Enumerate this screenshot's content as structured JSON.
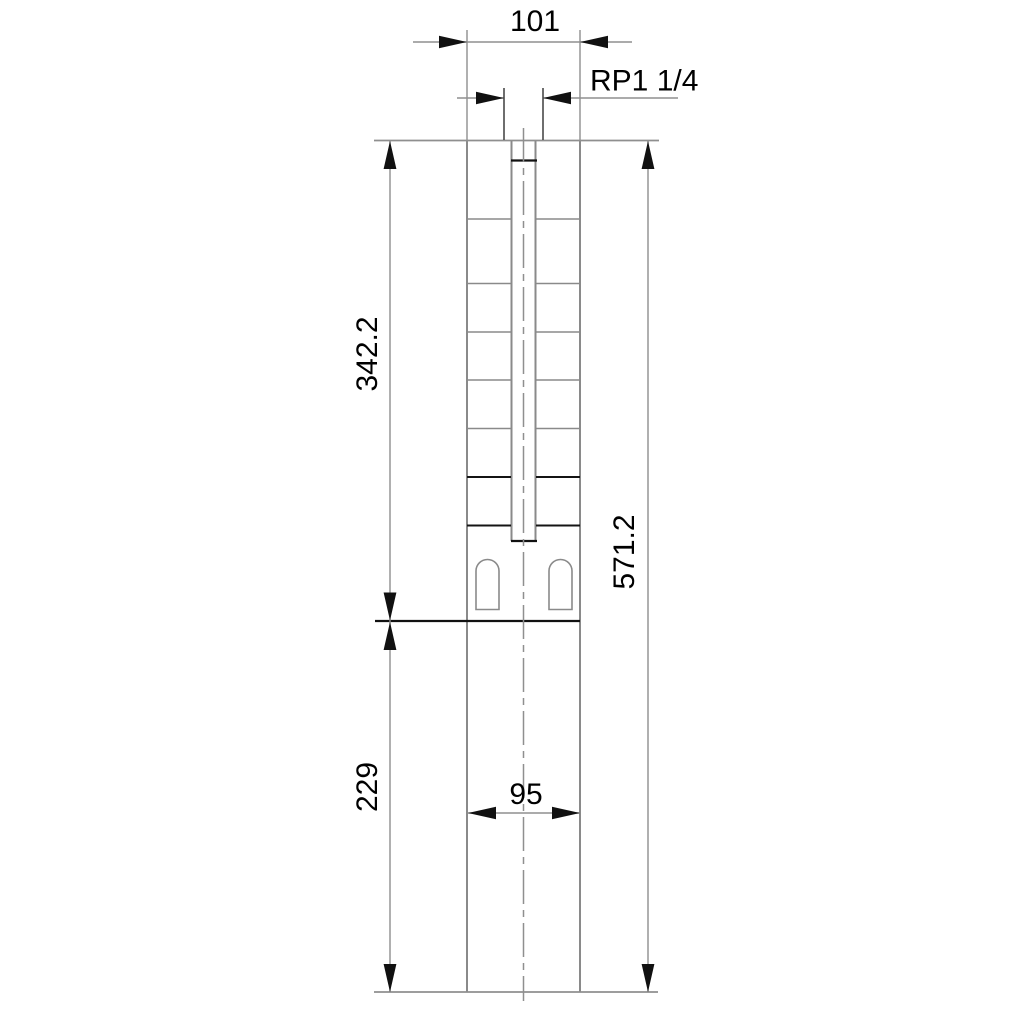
{
  "drawing": {
    "type": "technical-dimension-drawing",
    "subject": "submersible borehole pump outline with dimensions",
    "colors": {
      "background": "#ffffff",
      "object_line": "#8a8a8a",
      "dark_object_line": "#141414",
      "dimension_line": "#8f8f8f",
      "text": "#000000",
      "arrow_fill": "#111111"
    },
    "dims": {
      "top_width": {
        "label": "101",
        "orientation": "horizontal"
      },
      "port_thread": {
        "label": "RP1 1/4",
        "orientation": "horizontal"
      },
      "pump_section_length": {
        "label": "342.2",
        "orientation": "vertical"
      },
      "overall_length": {
        "label": "571.2",
        "orientation": "vertical"
      },
      "motor_section_length": {
        "label": "229",
        "orientation": "vertical"
      },
      "bottom_width": {
        "label": "95",
        "orientation": "horizontal"
      }
    }
  }
}
